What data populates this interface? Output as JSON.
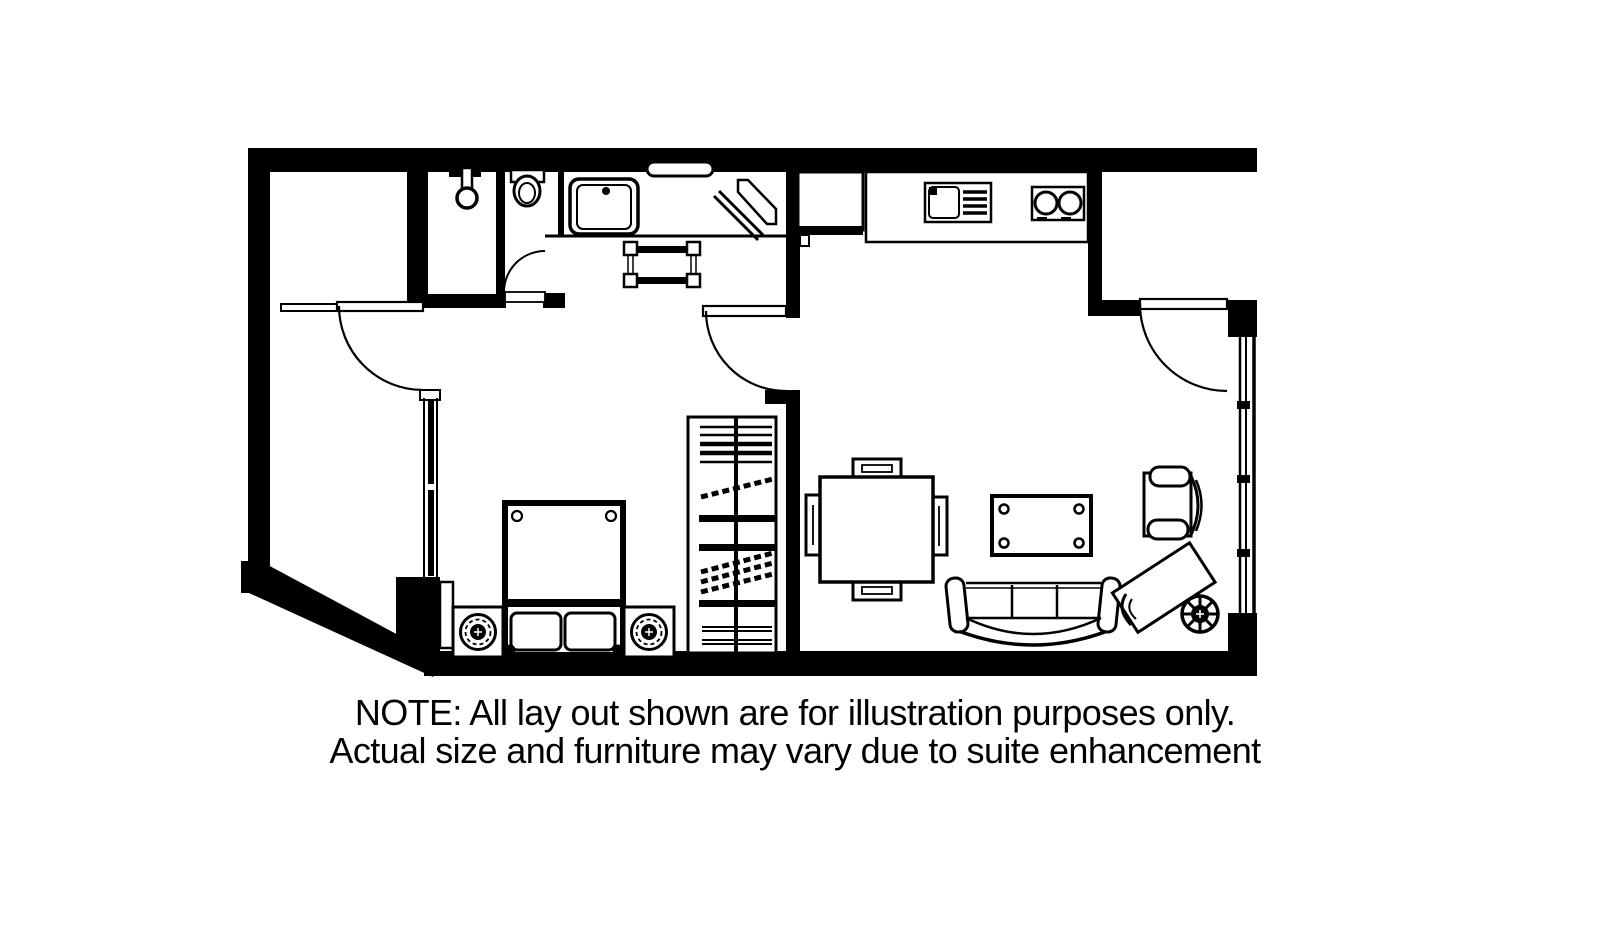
{
  "note": {
    "line1": "NOTE: All lay out shown are for illustration purposes only.",
    "line2": "Actual size and furniture may vary due to suite enhancement"
  },
  "plan": {
    "kind": "hotel-suite-floor-plan",
    "colors": {
      "ink": "#000000",
      "background": "#ffffff"
    },
    "symbols": [
      "shower-head",
      "toilet",
      "vanity-sink",
      "towel-shelf",
      "ironing-item",
      "luggage-bench",
      "refrigerator",
      "kitchen-counter",
      "kitchen-sink-with-drainboard",
      "two-burner-cooktop",
      "entry-door",
      "bathroom-door",
      "bedroom-door",
      "bedroom-inner-door",
      "double-bed",
      "pillows",
      "nightstand",
      "table-lamp",
      "closet-with-shelves-and-hangers",
      "bedroom-window",
      "structural-column",
      "dining-table",
      "dining-chair",
      "coffee-table",
      "sofa",
      "armchair",
      "chaise-lounge",
      "potted-plant",
      "living-room-window-wall",
      "diagonal-exterior-wall"
    ]
  }
}
